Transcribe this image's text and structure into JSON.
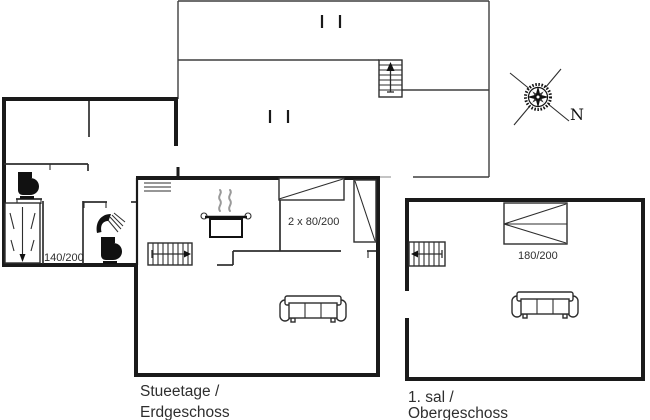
{
  "colors": {
    "background": "#ffffff",
    "wall": "#1a1a1a",
    "line": "#2e2e2e",
    "outline": "#3e3e3e",
    "faint": "#8a8a8a",
    "steam": "#9a9a9a",
    "icon": "#111111",
    "text": "#2e2e2e"
  },
  "labels": {
    "ground_floor": {
      "line1": "Stueetage /",
      "line2": "Erdgeschoss"
    },
    "upper_floor": {
      "line1": "1. sal /",
      "line2": "Obergeschoss"
    }
  },
  "beds": {
    "annex_double": {
      "size_label": "140/200"
    },
    "main_twin": {
      "size_label": "2 x 80/200"
    },
    "upper_double": {
      "size_label": "180/200"
    }
  },
  "compass": {
    "north_label": "N"
  },
  "icons": {
    "toilet": "toilet-icon",
    "shower": "shower-icon",
    "cooking_pot": "cooking-pot-icon",
    "steam": "steam-icon",
    "sofa": "sofa-icon",
    "stairs": "stairs-icon",
    "bed": "bed-icon",
    "compass_rose": "compass-rose-icon"
  }
}
